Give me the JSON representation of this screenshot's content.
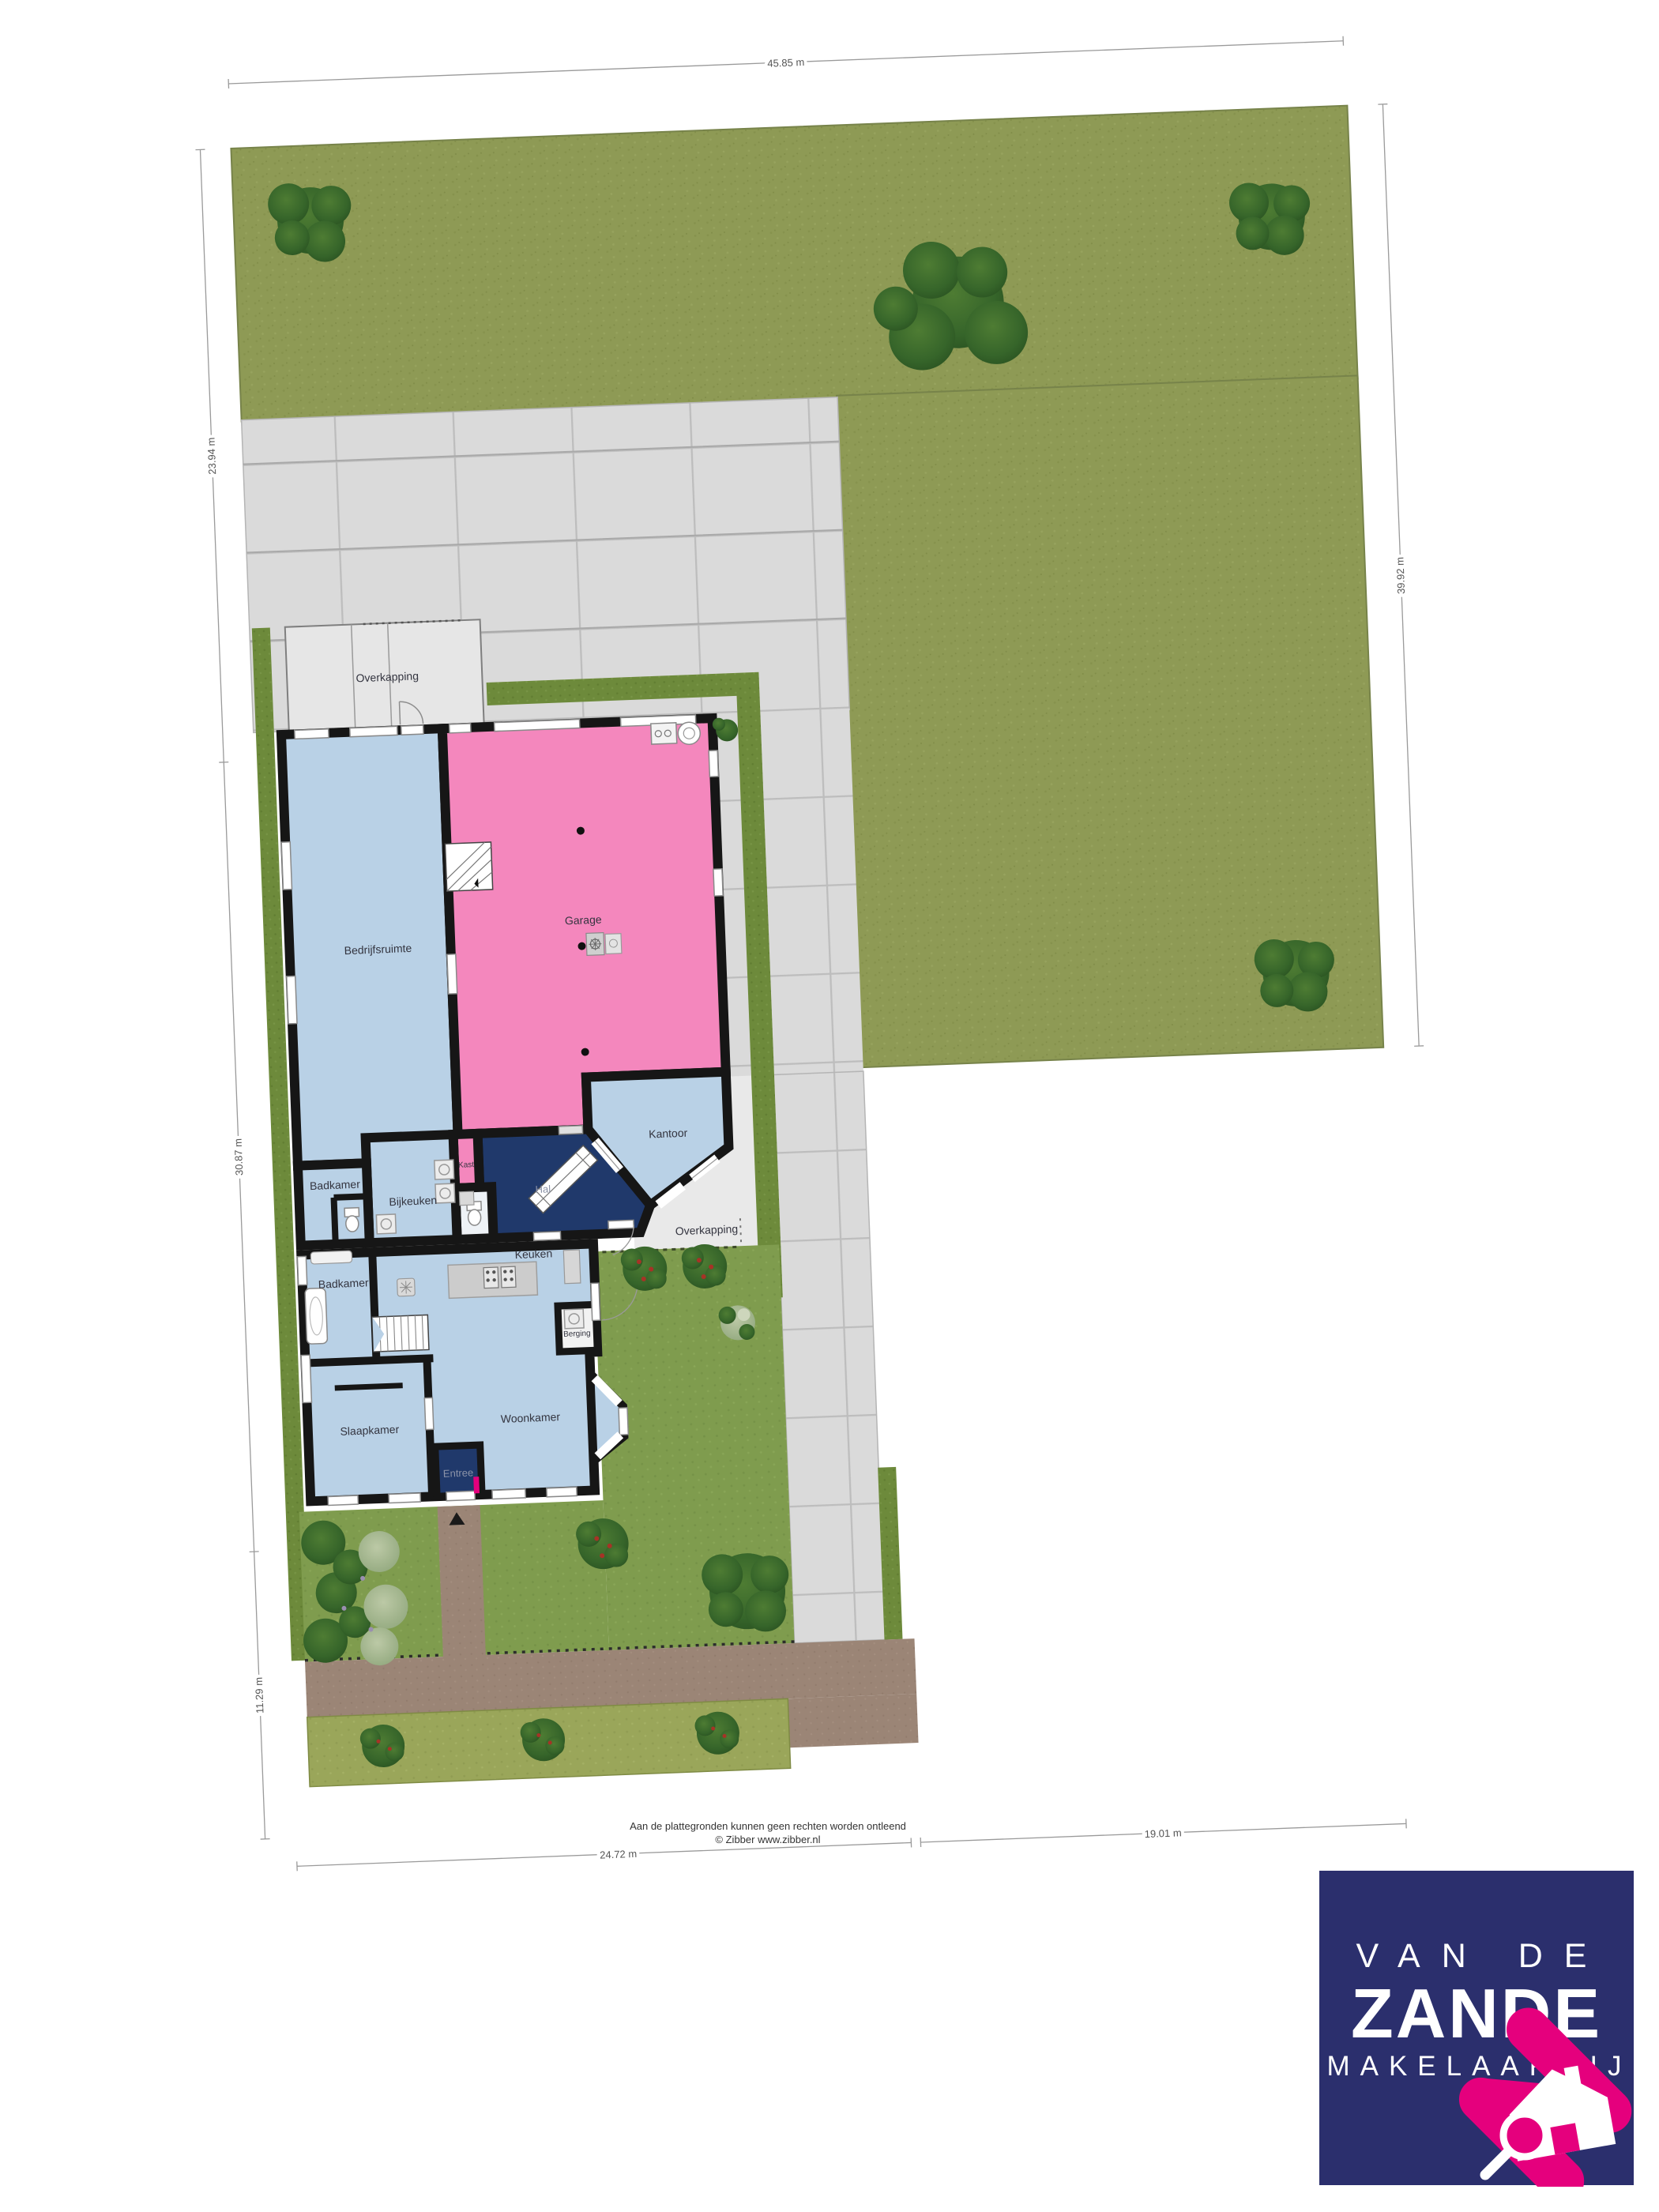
{
  "site": {
    "dimensions": {
      "top": "45.85 m",
      "left_upper": "23.94 m",
      "left_middle": "30.87 m",
      "left_lower": "11.29 m",
      "right": "39.92 m",
      "bottom_left": "24.72 m",
      "bottom_right": "19.01 m"
    }
  },
  "floorplan": {
    "labels": {
      "overkapping_top": "Overkapping",
      "bedrijfsruimte": "Bedrijfsruimte",
      "garage": "Garage",
      "kast": "Kast",
      "hal": "Hal",
      "kantoor": "Kantoor",
      "badkamer_boven": "Badkamer",
      "bijkeuken": "Bijkeuken",
      "overkapping_zij": "Overkapping",
      "badkamer_onder": "Badkamer",
      "keuken": "Keuken",
      "berging": "Berging",
      "slaapkamer": "Slaapkamer",
      "woonkamer": "Woonkamer",
      "entree": "Entree"
    }
  },
  "footer": {
    "disclaimer": "Aan de plattegronden kunnen geen rechten worden ontleend",
    "copyright": "© Zibber www.zibber.nl"
  },
  "logo": {
    "line1": "VAN DE",
    "line2": "ZANDE",
    "line3": "MAKELAARDIJ"
  },
  "colors": {
    "lawn": "#8e9a55",
    "garden": "#7f9c4e",
    "hedge": "#6d8a3b",
    "tile": "#dadada",
    "roof": "#e6e6e6",
    "path_brown": "#9b8576",
    "room_blue": "#b9d1e6",
    "room_navy": "#20396b",
    "room_pink": "#f487bd",
    "wall": "#161616",
    "logo_navy": "#2b2f6d",
    "logo_pink": "#e5007d"
  }
}
